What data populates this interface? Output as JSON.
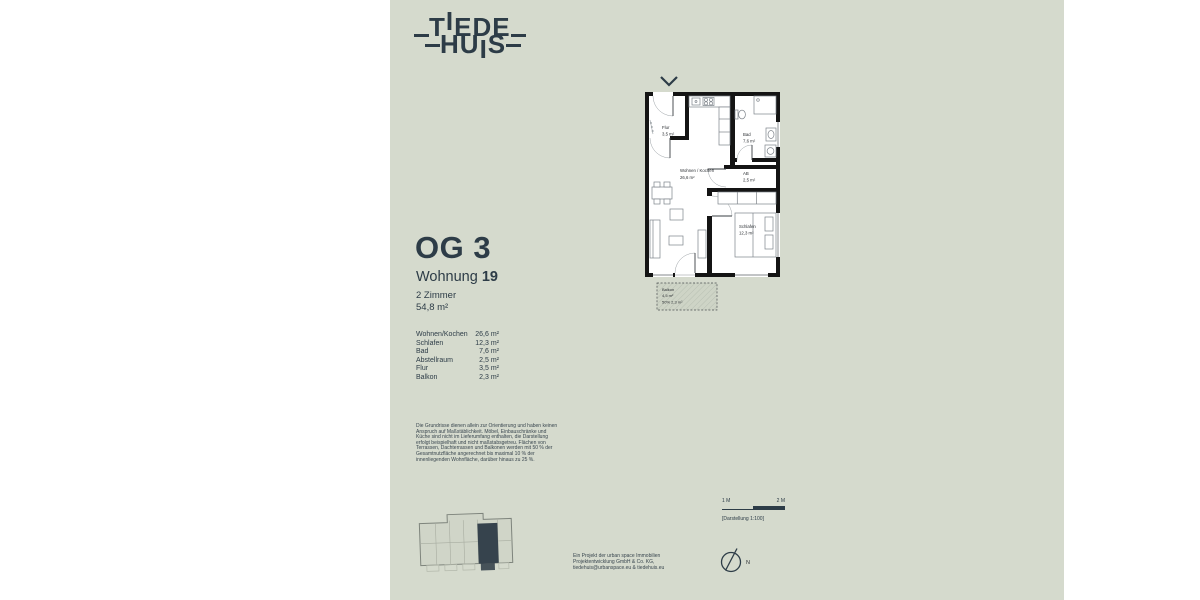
{
  "colors": {
    "background": "#ffffff",
    "panel": "#d5dacd",
    "ink": "#2d3c47",
    "wall": "#141414",
    "furniture": "#7d838a",
    "balkon_fill": "#ced4c6",
    "keyplan_unit": "#36434d"
  },
  "logo": {
    "t1": "T",
    "t2": "I",
    "t3": "EDE",
    "h1": "HU",
    "h2": "I",
    "h3": "S"
  },
  "header": {
    "floor": "OG 3",
    "unit_prefix": "Wohnung ",
    "unit_number": "19",
    "rooms": "2 Zimmer",
    "area": "54,8 m²"
  },
  "room_table": [
    {
      "label": "Wohnen/Kochen",
      "area": "26,6 m²"
    },
    {
      "label": "Schlafen",
      "area": "12,3 m²"
    },
    {
      "label": "Bad",
      "area": "7,6 m²"
    },
    {
      "label": "Abstellraum",
      "area": "2,5 m²"
    },
    {
      "label": "Flur",
      "area": "3,5 m²"
    },
    {
      "label": "Balkon",
      "area": "2,3 m²"
    }
  ],
  "disclaimer": "Die Grundrisse dienen allein zur Orientierung und haben keinen Anspruch auf Maßstäblichkeit. Möbel, Einbauschränke und Küche sind nicht im Lieferumfang enthalten, die Darstellung erfolgt beispielhaft und nicht maßstabsgetreu. Flächen von Terrassen, Dachterrassen und Balkonen werden mit 50 % der Gesamtnutzfläche angerechnet bis maximal 10 % der innenliegenden Wohnfläche, darüber hinaus zu 25 %.",
  "floorplan": {
    "flur": {
      "name": "Flur",
      "area": "3,5 m²"
    },
    "wohnen": {
      "name": "Wohnen / Kochen",
      "area": "26,6 m²"
    },
    "bad": {
      "name": "Bad",
      "area": "7,6 m²"
    },
    "ab": {
      "name": "AB",
      "area": "2,5 m²"
    },
    "schlafen": {
      "name": "Schlafen",
      "area": "12,3 m²"
    },
    "balkon": {
      "name": "Balkon",
      "area": "4,5 m²",
      "share": "50%  2,3 m²"
    }
  },
  "footer": {
    "line1": "Ein Projekt der urban space Immobilien",
    "line2": "Projektentwicklung GmbH & Co. KG,",
    "line3": "tiedehuis@urbanspace.eu & tiedehuis.eu"
  },
  "scalebar": {
    "left": "1 M",
    "right": "2 M",
    "caption": "[Darstellung 1:100]"
  },
  "compass": {
    "label": "N"
  }
}
